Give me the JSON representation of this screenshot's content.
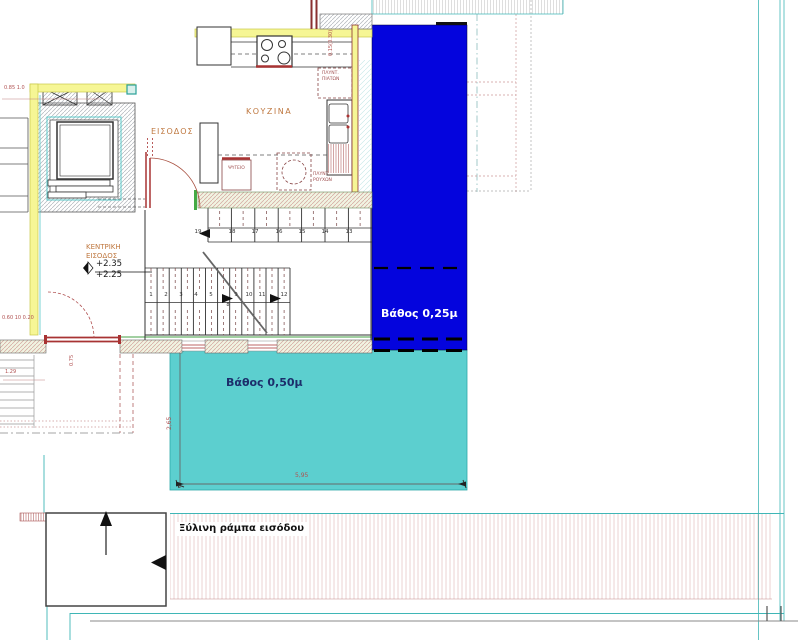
{
  "colors": {
    "deep_pool": "#0404dd",
    "shallow_pool": "#5ccfcf",
    "wall_yellow": "#f6f695",
    "cad_cyan": "#3fb6b6",
    "label_brown": "#bf7840",
    "dim_red": "#b05050"
  },
  "rooms": {
    "kitchen": "ΚΟΥΖΙΝΑ",
    "entrance": "ΕΙΣΟΔΟΣ",
    "main_entrance_l1": "ΚΕΝΤΡΙΚΗ",
    "main_entrance_l2": "ΕΙΣΟΔΟΣ"
  },
  "levels": {
    "upper": "+2.35",
    "lower": "+2.25"
  },
  "appliances": {
    "fridge": "ΨΥΓΕΙΟ",
    "dishwasher_l1": "ΠΛΥΝΤ.",
    "dishwasher_l2": "ΠΙΑΤΩΝ",
    "washer_l1": "ΠΛΥΝΤ.",
    "washer_l2": "ΡΟΥΧΩΝ"
  },
  "pools": {
    "deep_label": "Βάθος 0,25μ",
    "shallow_label": "Βάθος 0,50μ"
  },
  "ramp": {
    "label": "Ξύλινη ράμπα εισόδου"
  },
  "dims": {
    "shallow_width": "5,95",
    "shallow_depth": "2,65",
    "entrance_wall": "0.60 10 0.20",
    "left_offset": "1.29",
    "top_left": "0.85 1.0",
    "wall_top": "0.15(0.30)",
    "door": "0.75"
  },
  "stairs": {
    "upper": [
      "19",
      "18",
      "17",
      "16",
      "15",
      "14",
      "13"
    ],
    "lower": [
      "1",
      "2",
      "3",
      "4",
      "5",
      "9",
      "10",
      "11",
      "12"
    ],
    "landing": "8"
  }
}
